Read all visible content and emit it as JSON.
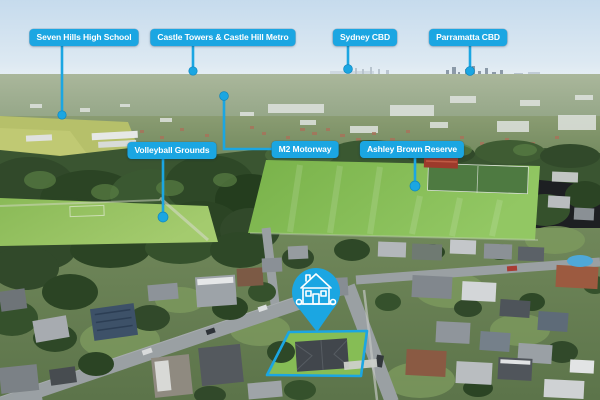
{
  "theme": {
    "accent_color": "#1BA6E2",
    "label_text_color": "#FFFFFF"
  },
  "callouts": [
    {
      "id": "seven-hills-high-school",
      "label": "Seven Hills High School"
    },
    {
      "id": "castle-towers-castle-hill-metro",
      "label": "Castle Towers & Castle Hill Metro"
    },
    {
      "id": "sydney-cbd",
      "label": "Sydney CBD"
    },
    {
      "id": "parramatta-cbd",
      "label": "Parramatta CBD"
    },
    {
      "id": "volleyball-grounds",
      "label": "Volleyball Grounds"
    },
    {
      "id": "m2-motorway",
      "label": "M2 Motorway"
    },
    {
      "id": "ashley-brown-reserve",
      "label": "Ashley Brown Reserve"
    }
  ],
  "property_marker": {
    "icon": "house-pin-icon"
  },
  "property_boundary": {
    "style": "outline"
  }
}
